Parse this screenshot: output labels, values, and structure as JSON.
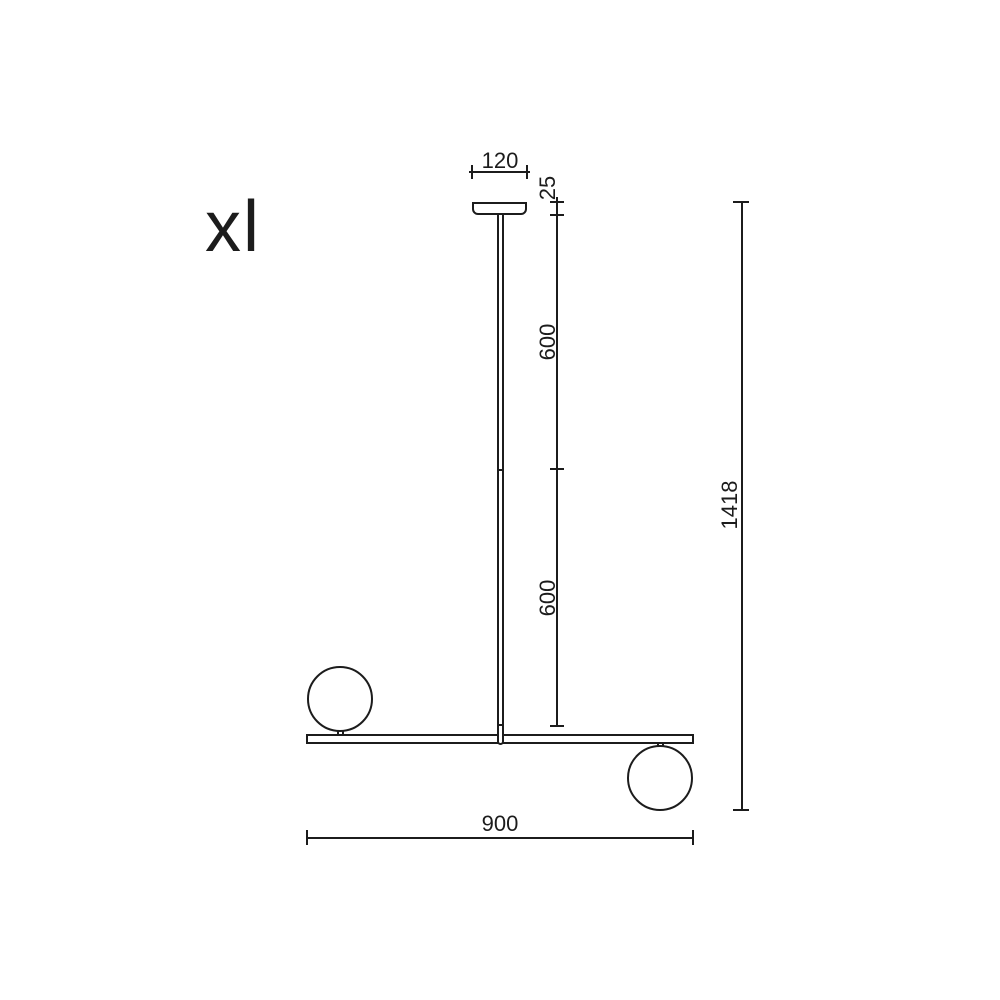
{
  "colors": {
    "ink": "#1c1c1c",
    "background": "#ffffff"
  },
  "drawing": {
    "variant_label": "xl",
    "dims": {
      "canopy_width": "120",
      "canopy_drop": "25",
      "rod_upper": "600",
      "rod_lower": "600",
      "overall_height": "1418",
      "bar_length": "900"
    }
  }
}
